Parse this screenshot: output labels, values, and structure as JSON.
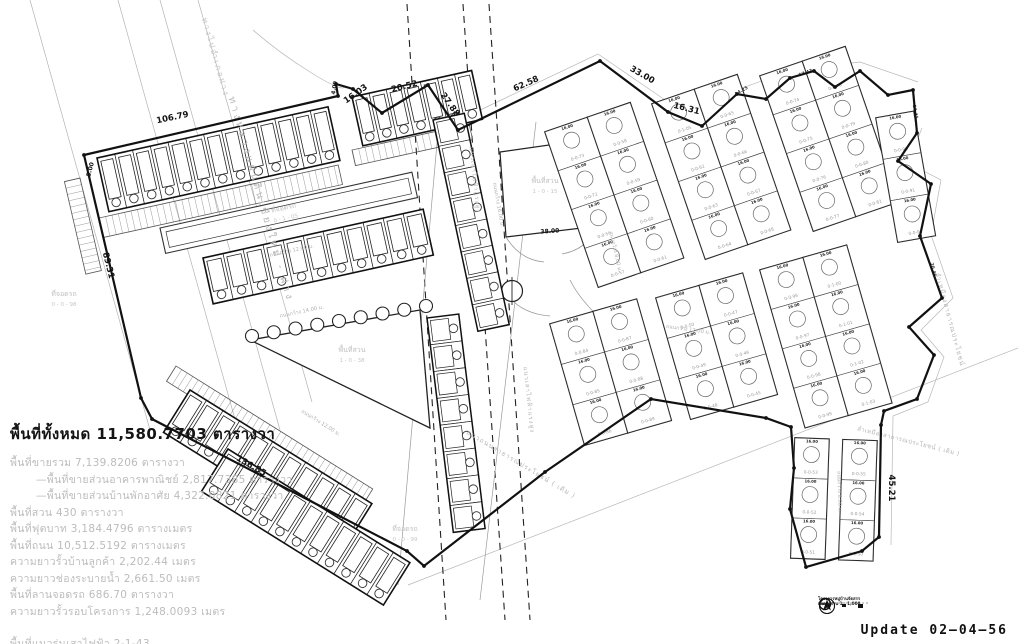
{
  "title_block": {
    "title": "พื้นที่ทั้งหมด  11,580.7703  ตารางวา",
    "lines": [
      "พื้นที่ขายรวม  7,139.8206  ตารางวา",
      "—พื้นที่ขายส่วนอาคารพาณิชย์  2,817.7385  ตารางวา",
      "—พื้นที่ขายส่วนบ้านพักอาศัย  4,322.0821  ตารางวา",
      "พื้นที่สวน  430  ตารางวา",
      "พื้นที่ฟุตบาท  3,184.4796  ตารางเมตร",
      "พื้นที่ถนน  10,512.5192   ตารางเมตร",
      "ความยาวรั้วบ้านลูกค้า   2,202.44  เมตร",
      "ความยาวช่องระบายน้ำ   2,661.50  เมตร",
      "พื้นที่ลานจอดรถ   686.70  ตารางวา",
      "ความยาวรั้วรอบโครงการ  1,248.0093  เมตร",
      "พื้นที่แนวร่นเสาไฟฟ้า  2-1-43"
    ]
  },
  "update_label": "Update 02–04–56",
  "legend": {
    "project_line": "โครงการหมู่บ้านจัดสรร",
    "scale_line": "มาตราส่วน 1 : 1,000"
  },
  "plan": {
    "dimensions": [
      {
        "text": "106.79",
        "x": 173,
        "y": 120,
        "rot": -12
      },
      {
        "text": "16.03",
        "x": 357,
        "y": 96,
        "rot": -35
      },
      {
        "text": "20.52",
        "x": 405,
        "y": 89,
        "rot": -14
      },
      {
        "text": "27.88",
        "x": 448,
        "y": 106,
        "rot": 55
      },
      {
        "text": "62.58",
        "x": 527,
        "y": 86,
        "rot": -24
      },
      {
        "text": "33.00",
        "x": 641,
        "y": 77,
        "rot": 30
      },
      {
        "text": "16.31",
        "x": 686,
        "y": 111,
        "rot": 14
      },
      {
        "text": "89.31",
        "x": 106,
        "y": 266,
        "rot": 76
      },
      {
        "text": "136.85",
        "x": 250,
        "y": 468,
        "rot": 30
      },
      {
        "text": "45.21",
        "x": 889,
        "y": 488,
        "rot": 90
      },
      {
        "text": "5.00",
        "x": 92,
        "y": 170,
        "rot": -75,
        "size": 6
      },
      {
        "text": "4.09",
        "x": 336,
        "y": 88,
        "rot": -80,
        "size": 5.5
      },
      {
        "text": "38.00",
        "x": 550,
        "y": 233,
        "rot": -4,
        "size": 6
      }
    ],
    "small_dimensions": [
      {
        "text": "14.25",
        "x": 742,
        "y": 92,
        "rot": -30
      },
      {
        "text": "17.43",
        "x": 806,
        "y": 74,
        "rot": -20
      },
      {
        "text": "16.41",
        "x": 914,
        "y": 112,
        "rot": 80
      },
      {
        "text": "20.46",
        "x": 932,
        "y": 270,
        "rot": 75
      }
    ],
    "edge_labels": [
      {
        "text": "ทางหลวงแผ่นดินเชียงใหม่ - ฝาง",
        "x": 258,
        "y": 200,
        "rot": 74,
        "size": 10,
        "ls": 3,
        "color": "#b8b8b8"
      },
      {
        "text": "ทางไปอำเภอฝาง",
        "x": 213,
        "y": 58,
        "rot": 74,
        "size": 8,
        "ls": 2,
        "color": "#c6c6c6"
      },
      {
        "text": "ลำเหมืองสาธารณประโยชน์",
        "x": 948,
        "y": 320,
        "rot": 75,
        "size": 6.5,
        "ls": 1,
        "color": "#b5b5b5"
      },
      {
        "text": "แนวถนนสาธารณประโยชน์ ( เดิม )",
        "x": 520,
        "y": 466,
        "rot": 31,
        "size": 6.5,
        "ls": 1,
        "color": "#b5b5b5"
      },
      {
        "text": "ลำเหมืองสาธารณประโยชน์ ( เดิม )",
        "x": 908,
        "y": 443,
        "rot": 14,
        "size": 6,
        "ls": 0.5,
        "color": "#b5b5b5"
      },
      {
        "text": "แนวเสาไฟฟ้าแรงสูง",
        "x": 473,
        "y": 180,
        "rot": 84,
        "size": 6,
        "ls": 1,
        "color": "#b5b5b5"
      },
      {
        "text": "แนวเสาไฟฟ้าแรงสูง",
        "x": 527,
        "y": 400,
        "rot": 84,
        "size": 6,
        "ls": 1,
        "color": "#b5b5b5"
      }
    ],
    "road_labels": [
      {
        "text": "ถนนกว้าง 12.00 ม.",
        "x": 292,
        "y": 252,
        "rot": -12.5
      },
      {
        "text": "ถนนกว้าง 14.00 ม.",
        "x": 302,
        "y": 313,
        "rot": -12
      },
      {
        "text": "ถนนกว้าง 16.00 ม.",
        "x": 497,
        "y": 205,
        "rot": 80
      },
      {
        "text": "ถนนกว้าง 12.00 ม.",
        "x": 688,
        "y": 331,
        "rot": 8
      },
      {
        "text": "ถนนกว้าง 8.00 ม.",
        "x": 614,
        "y": 252,
        "rot": 77
      },
      {
        "text": "ถนนกว้าง 8.00 ม.",
        "x": 838,
        "y": 492,
        "rot": 88
      },
      {
        "text": "ถนนกว้าง 12.00 ม.",
        "x": 320,
        "y": 424,
        "rot": 32
      }
    ],
    "area_labels": [
      {
        "title": "พื้นที่สวน",
        "sub": "1 - 0 - 15",
        "x": 545,
        "y": 183,
        "rot": 0
      },
      {
        "title": "พื้นที่สวน",
        "sub": "1 - 0 - 38",
        "x": 352,
        "y": 352,
        "rot": 0
      },
      {
        "title": "ที่จอดรถ",
        "sub": "0 - 1 - 05",
        "x": 284,
        "y": 210,
        "rot": -12.5
      },
      {
        "title": "ที่จอดรถ",
        "sub": "0 - 0 - 98",
        "x": 64,
        "y": 296,
        "rot": 0
      },
      {
        "title": "ที่จอดรถ",
        "sub": "0 - 0 - 99",
        "x": 405,
        "y": 531,
        "rot": 0
      }
    ],
    "lot_cell_dim": "16.00",
    "lot_id_groups": {
      "a1": [
        "0-0-73",
        "0-0-72",
        "0-0-56",
        "0-0-57",
        "0-0-58",
        "0-0-59",
        "0-0-60",
        "0-0-61"
      ],
      "a2": [
        "0-1-05",
        "0-0-62",
        "0-0-63",
        "0-0-64",
        "0-0-65",
        "0-0-66",
        "0-0-67",
        "0-0-68"
      ],
      "a3": [
        "0-0-74",
        "0-0-75",
        "0-0-76",
        "0-0-77",
        "0-0-78",
        "0-0-79",
        "0-0-80",
        "0-0-81"
      ],
      "a4": [
        "0-0-90",
        "0-0-91",
        "0-0-92"
      ],
      "b1": [
        "0-0-84",
        "0-0-85",
        "0-0-86",
        "0-0-87",
        "0-0-88",
        "0-0-89"
      ],
      "b2": [
        "0-0-50",
        "0-0-49",
        "0-0-48",
        "0-0-47",
        "0-0-46",
        "0-0-45"
      ],
      "b3": [
        "0-0-96",
        "0-0-97",
        "0-0-98",
        "0-0-99",
        "0-1-00",
        "0-1-01",
        "0-1-02",
        "0-1-03"
      ],
      "tail": [
        "0-0-53",
        "0-0-52",
        "0-0-51",
        "0-0-55",
        "0-0-54",
        "0-0-50"
      ]
    }
  }
}
